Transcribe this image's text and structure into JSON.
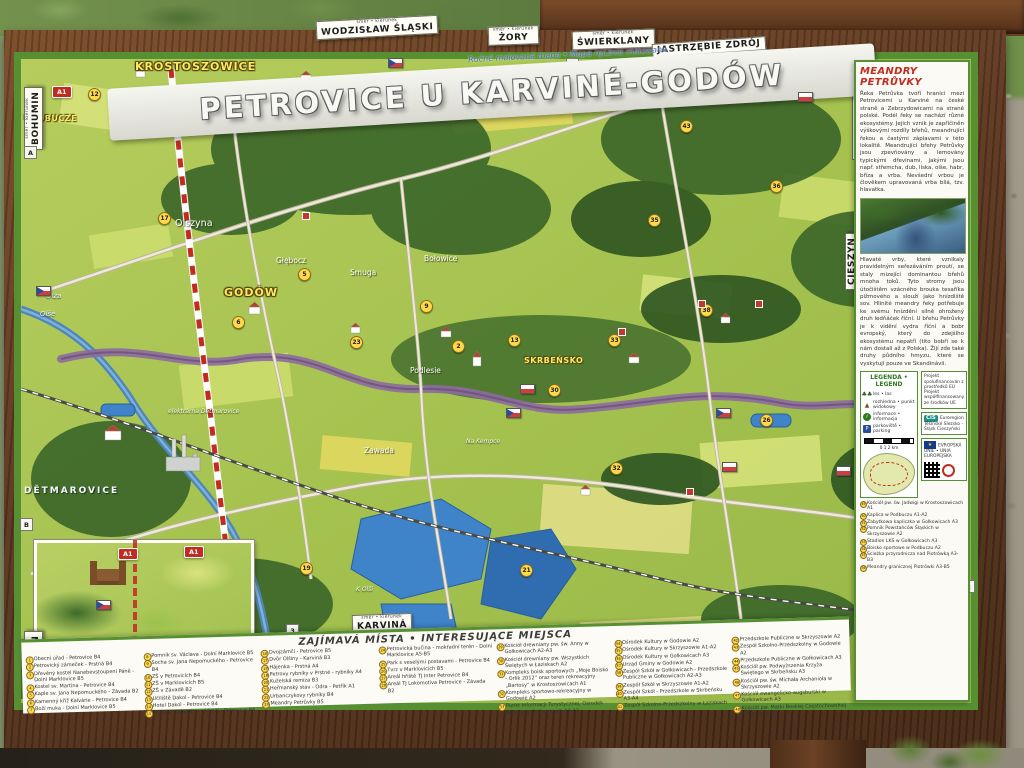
{
  "header": {
    "title": "PETROVICE U KARVINÉ-GODÓW",
    "subtitle": "Ručně malovaná mapa • Mapa ręcznie malowana"
  },
  "signs": [
    {
      "text": "BOHUMIN",
      "sub": "směr • kierunek",
      "x": 24,
      "y": 150,
      "vertical": true
    },
    {
      "text": "WODZISŁAW ŚLĄSKI",
      "sub": "směr • kierunek",
      "x": 316,
      "y": 18,
      "rot": -3
    },
    {
      "text": "ŻORY",
      "sub": "směr • kierunek",
      "x": 488,
      "y": 26,
      "rot": -2
    },
    {
      "text": "ŚWIERKLANY",
      "sub": "směr • kierunek",
      "x": 572,
      "y": 30,
      "rot": -2
    },
    {
      "text": "JASTRZĘBIE ZDRÓJ",
      "sub": "",
      "x": 652,
      "y": 40,
      "rot": -4
    },
    {
      "text": "KARVINÁ",
      "sub": "směr • kierunek",
      "x": 352,
      "y": 614,
      "rot": -2
    },
    {
      "text": "BOHUMÍN",
      "sub": "směr • kierunek",
      "x": 24,
      "y": 694,
      "vertical": true
    },
    {
      "text": "PSZCZYNA",
      "sub": "",
      "x": 852,
      "y": 160,
      "vertical": true
    },
    {
      "text": "CIESZYN",
      "sub": "",
      "x": 845,
      "y": 290,
      "vertical": true
    }
  ],
  "map": {
    "labels": [
      {
        "text": "KROSTOSZOWICE",
        "x": 135,
        "y": 60,
        "cls": "l-town"
      },
      {
        "text": "SKRZYSZÓW",
        "x": 268,
        "y": 86,
        "cls": "l-town"
      },
      {
        "text": "PODBUCZE",
        "x": 24,
        "y": 114,
        "cls": "l-town-sm"
      },
      {
        "text": "GODÓW",
        "x": 224,
        "y": 286,
        "cls": "l-town"
      },
      {
        "text": "SKRBEŃSKO",
        "x": 524,
        "y": 356,
        "cls": "l-town-sm"
      },
      {
        "text": "Olszyna",
        "x": 175,
        "y": 218,
        "cls": "l-wh"
      },
      {
        "text": "Głębocz",
        "x": 276,
        "y": 256,
        "cls": "l-wh-sm"
      },
      {
        "text": "Smuga",
        "x": 350,
        "y": 268,
        "cls": "l-wh-sm"
      },
      {
        "text": "Bołowice",
        "x": 424,
        "y": 254,
        "cls": "l-wh-sm"
      },
      {
        "text": "Podlesie",
        "x": 410,
        "y": 366,
        "cls": "l-wh-sm"
      },
      {
        "text": "Zawada",
        "x": 364,
        "y": 446,
        "cls": "l-wh-sm"
      },
      {
        "text": "Na Kempce",
        "x": 466,
        "y": 438,
        "cls": "l-wh-xs"
      },
      {
        "text": "DĚTMAROVICE",
        "x": 24,
        "y": 486,
        "cls": "l-caps"
      },
      {
        "text": "elektrárna Dětmarovice",
        "x": 168,
        "y": 408,
        "cls": "l-wh-xs"
      },
      {
        "text": "Olza",
        "x": 46,
        "y": 292,
        "cls": "l-river"
      },
      {
        "text": "Olše",
        "x": 40,
        "y": 310,
        "cls": "l-river"
      },
      {
        "text": "K Olši",
        "x": 356,
        "y": 586,
        "cls": "l-wh-xs"
      }
    ],
    "grid": [
      {
        "label": "3",
        "x": 566,
        "y": 58
      },
      {
        "label": "4",
        "x": 820,
        "y": 62
      },
      {
        "label": "A",
        "x": 24,
        "y": 146
      },
      {
        "label": "B",
        "x": 20,
        "y": 518
      },
      {
        "label": "A",
        "x": 858,
        "y": 188
      },
      {
        "label": "3",
        "x": 286,
        "y": 624
      },
      {
        "label": "2",
        "x": 962,
        "y": 580
      }
    ],
    "badges": [
      {
        "n": "12",
        "x": 88,
        "y": 88
      },
      {
        "n": "17",
        "x": 158,
        "y": 212
      },
      {
        "n": "6",
        "x": 232,
        "y": 316
      },
      {
        "n": "5",
        "x": 298,
        "y": 268
      },
      {
        "n": "23",
        "x": 350,
        "y": 336
      },
      {
        "n": "9",
        "x": 420,
        "y": 300
      },
      {
        "n": "2",
        "x": 452,
        "y": 340
      },
      {
        "n": "13",
        "x": 508,
        "y": 334
      },
      {
        "n": "30",
        "x": 548,
        "y": 384
      },
      {
        "n": "33",
        "x": 608,
        "y": 334
      },
      {
        "n": "35",
        "x": 648,
        "y": 214
      },
      {
        "n": "38",
        "x": 700,
        "y": 304
      },
      {
        "n": "26",
        "x": 760,
        "y": 414
      },
      {
        "n": "21",
        "x": 520,
        "y": 564
      },
      {
        "n": "32",
        "x": 610,
        "y": 462
      },
      {
        "n": "19",
        "x": 300,
        "y": 562
      },
      {
        "n": "43",
        "x": 680,
        "y": 120
      },
      {
        "n": "36",
        "x": 770,
        "y": 180
      }
    ],
    "a1": [
      {
        "x": 52,
        "y": 86
      },
      {
        "x": 184,
        "y": 546
      },
      {
        "x": 118,
        "y": 548
      }
    ],
    "landmarks": [
      {
        "x": 505,
        "y": 92
      },
      {
        "x": 618,
        "y": 328
      },
      {
        "x": 698,
        "y": 300
      },
      {
        "x": 686,
        "y": 488
      },
      {
        "x": 302,
        "y": 212
      },
      {
        "x": 755,
        "y": 300
      }
    ],
    "flags": [
      {
        "type": "cz",
        "x": 36,
        "y": 286
      },
      {
        "type": "cz",
        "x": 506,
        "y": 408
      },
      {
        "type": "cz",
        "x": 96,
        "y": 600
      },
      {
        "type": "cz",
        "x": 716,
        "y": 408
      },
      {
        "type": "pl",
        "x": 520,
        "y": 384
      },
      {
        "type": "pl",
        "x": 836,
        "y": 466
      },
      {
        "type": "pl",
        "x": 722,
        "y": 462
      }
    ]
  },
  "panel": {
    "title": "MEANDRY PETRŮVKY",
    "para1": "Řeka Petrůvka tvoří hranici mezi Petrovicemi u Karviné na české straně a Zebrzydowicami na straně polské. Podél řeky se nachází různé ekosystémy. Jejich vznik je zapříčiněn výškovými rozdíly břehů, meandrující řekou a častými záplavami v této lokalitě. Meandrující břehy Petrůvky jsou zpevňovány a lemovány typickými dřevinami, jakými jsou např. střemcha, dub, líska, olše, habr, bříza a vrba. Nevšední vrbou je člověkem upravovaná vrba bílá, tzv. hlavatka.",
    "para2": "Hlavaté vrby, které vznikaly pravidelným seřezáváním proutí, se staly mizející dominantou břehů mnoha toků. Tyto stromy jsou útočištěm vzácného brouka tesaříka pižmového a slouží jako hnízdiště sov. Hlinité meandry řeky potřebuje ke svému hnízdění silně ohrožený druh ledňáček říční. U břehu Petrůvky je k vidění vydra říční a bobr evropský, který do zdejšího ekosystému nepatří (tito bobři se k nám dostali až z Polska). Žijí zde také druhy půdního hmyzu, které se vyskytují pouze ve Skandinávii.",
    "legend": {
      "title": "LEGENDA • LEGEND",
      "items": [
        {
          "icon": "trees",
          "glyph": "♣♣",
          "label": "les • las"
        },
        {
          "icon": "viewpoint",
          "glyph": "▲",
          "label": "rozhledna • punkt widokowy"
        },
        {
          "icon": "info",
          "glyph": "i",
          "label": "informace • informacja"
        },
        {
          "icon": "parking",
          "glyph": "P",
          "label": "parkoviště • parking"
        }
      ],
      "scale_label": "0      1      2 km"
    },
    "boxes": {
      "box1_line1": "Projekt spolufinancován z prostředků EU",
      "box1_line2": "Projekt współfinansowany ze środków UE",
      "box2_logo": "CiS",
      "box2_text": "Euroregion Těšínské Slezsko - Śląsk Cieszyński",
      "eu_star": "★",
      "box3_text": "EVROPSKÁ UNIE • UNIA EUROPEJSKA"
    },
    "list": [
      {
        "n": "49",
        "t": "Kościół pw. św. Jadwigi w Krostoszowicach A1"
      },
      {
        "n": "50",
        "t": "Kaplica w Podbuczu A1-A2"
      },
      {
        "n": "51",
        "t": "Zabytkowa kapliczka w Gołkowicach A3"
      },
      {
        "n": "52",
        "t": "Pomnik Powstańców Śląskich w Skrzyszowie A2"
      },
      {
        "n": "53",
        "t": "Stadion LKS w Gołkowicach A3"
      },
      {
        "n": "54",
        "t": "Boisko sportowe w Podbuczu A2"
      },
      {
        "n": "55",
        "t": "Ścieżka przyrodnicza nad Piotrówką A3-B3"
      },
      {
        "n": "56",
        "t": "Meandry granicznej Piotrówki A3-B5"
      }
    ]
  },
  "poi": {
    "title": "ZAJÍMAVÁ MÍSTA • INTERESUJĄCE MIEJSCA",
    "columns": [
      [
        {
          "n": "1",
          "t": "Obecní úřad - Petrovice B4"
        },
        {
          "n": "2",
          "t": "Petrovický zámeček - Prstná B4"
        },
        {
          "n": "3",
          "t": "Dřevěný kostel Nanebevstoupení Páně - Dolní Marklovice B5"
        },
        {
          "n": "4",
          "t": "Kostel sv. Martina - Petrovice B4"
        },
        {
          "n": "5",
          "t": "Kaple sv. Jana Nepomuckého - Závada B2"
        },
        {
          "n": "6",
          "t": "Kamenný kříž Kalvárie - Petrovice B4"
        },
        {
          "n": "7",
          "t": "Boží muka - Dolní Marklovice B5"
        }
      ],
      [
        {
          "n": "8",
          "t": "Pomník sv. Václava - Dolní Marklovice B5"
        },
        {
          "n": "9",
          "t": "Socha sv. Jana Nepomuckého - Petrovice B4"
        },
        {
          "n": "10",
          "t": "ZŠ v Petrovicích B4"
        },
        {
          "n": "11",
          "t": "ZŠ v Marklovicích B5"
        },
        {
          "n": "12",
          "t": "ZŠ v Závadě B2"
        },
        {
          "n": "13",
          "t": "Učiliště Dakol - Petrovice B4"
        },
        {
          "n": "14",
          "t": "Hotel Dakol - Petrovice B4"
        },
        {
          "n": "15",
          "t": "Budova vlakového nádraží - Petrovice B4"
        }
      ],
      [
        {
          "n": "16",
          "t": "Dvojzámčí - Petrovice B5"
        },
        {
          "n": "17",
          "t": "Dvůr Olšiny - Karviná B3"
        },
        {
          "n": "18",
          "t": "Hájenka - Prstná A4"
        },
        {
          "n": "19",
          "t": "Petrovy rybníky v Prstné - rybníky A4"
        },
        {
          "n": "20",
          "t": "Kuželská remíza B3"
        },
        {
          "n": "21",
          "t": "Heřmanský stav - Odra - Petřík A1"
        },
        {
          "n": "22",
          "t": "Urbanczykovy rybníky B4"
        },
        {
          "n": "23",
          "t": "Meandry Petrůvky B5"
        }
      ],
      [
        {
          "n": "24",
          "t": "Petrovická bučina - mokřadní terén - Dolní Marklovice A5-B5"
        },
        {
          "n": "25",
          "t": "Park s veselými postavami - Petrovice B4"
        },
        {
          "n": "26",
          "t": "Tvrz v Marklovicích B5"
        },
        {
          "n": "27",
          "t": "Areál hřiště TJ Inter Petrovice B4"
        },
        {
          "n": "28",
          "t": "Areál TJ Lokomotiva Petrovice - Závada B2"
        }
      ],
      [
        {
          "n": "29",
          "t": "Kościół drewniany pw. św. Anny w Gołkowicach A2-A3"
        },
        {
          "n": "30",
          "t": "Kościół drewniany pw. Wszystkich Świętych w Łaziskach A2"
        },
        {
          "n": "31",
          "t": "Kompleks boisk sportowych „Moje Boisko - Orlik 2012” oraz teren rekreacyjny „Bartosy” w Krostoszowicach A1"
        },
        {
          "n": "32",
          "t": "Kompleks sportowo-rekreacyjny w Godowie A2"
        },
        {
          "n": "33",
          "t": "Punkt Informacji Turystycznej, Ośrodek Kultury w Gołkowicach A2-A3"
        }
      ],
      [
        {
          "n": "34",
          "t": "Ośrodek Kultury w Godowie A2"
        },
        {
          "n": "35",
          "t": "Ośrodek Kultury w Skrzyszowie A1-A2"
        },
        {
          "n": "36",
          "t": "Ośrodek Kultury w Gołkowicach A3"
        },
        {
          "n": "37",
          "t": "Urząd Gminy w Godowie A2"
        },
        {
          "n": "38",
          "t": "Zespół Szkół w Gołkowicach - Przedszkole Publiczne w Gołkowicach A2-A3"
        },
        {
          "n": "39",
          "t": "Zespół Szkół w Skrzyszowie A1-A2"
        },
        {
          "n": "40",
          "t": "Zespół Szkół - Przedszkole w Skrbeńsku A3-A4"
        },
        {
          "n": "41",
          "t": "Zespół Szkolno-Przedszkolny w Łaziskach A2"
        }
      ],
      [
        {
          "n": "42",
          "t": "Przedszkole Publiczne w Skrzyszowie A2"
        },
        {
          "n": "43",
          "t": "Zespół Szkolno-Przedszkolny w Godowie A2"
        },
        {
          "n": "44",
          "t": "Przedszkole Publiczne w Gołkowicach A3"
        },
        {
          "n": "45",
          "t": "Kościół pw. Podwyższenia Krzyża Świętego w Skrbeńsku A3"
        },
        {
          "n": "46",
          "t": "Kościół pw. św. Michała Archanioła w Skrzyszowie A2"
        },
        {
          "n": "47",
          "t": "Kościół ewangelicko-augsburski w Gołkowicach A3"
        },
        {
          "n": "48",
          "t": "Kościół pw. Matki Boskiej Częstochowskiej w Godowie A2"
        }
      ]
    ]
  },
  "colors": {
    "wood": "#5e3820",
    "map_green": "#aac653",
    "forest": "#3c672a",
    "water": "#3f83c9",
    "border_river": "#8d6b9e",
    "accent_red": "#c22b20",
    "poi_yellow": "#ffd94a",
    "margin_green": "#579032"
  }
}
